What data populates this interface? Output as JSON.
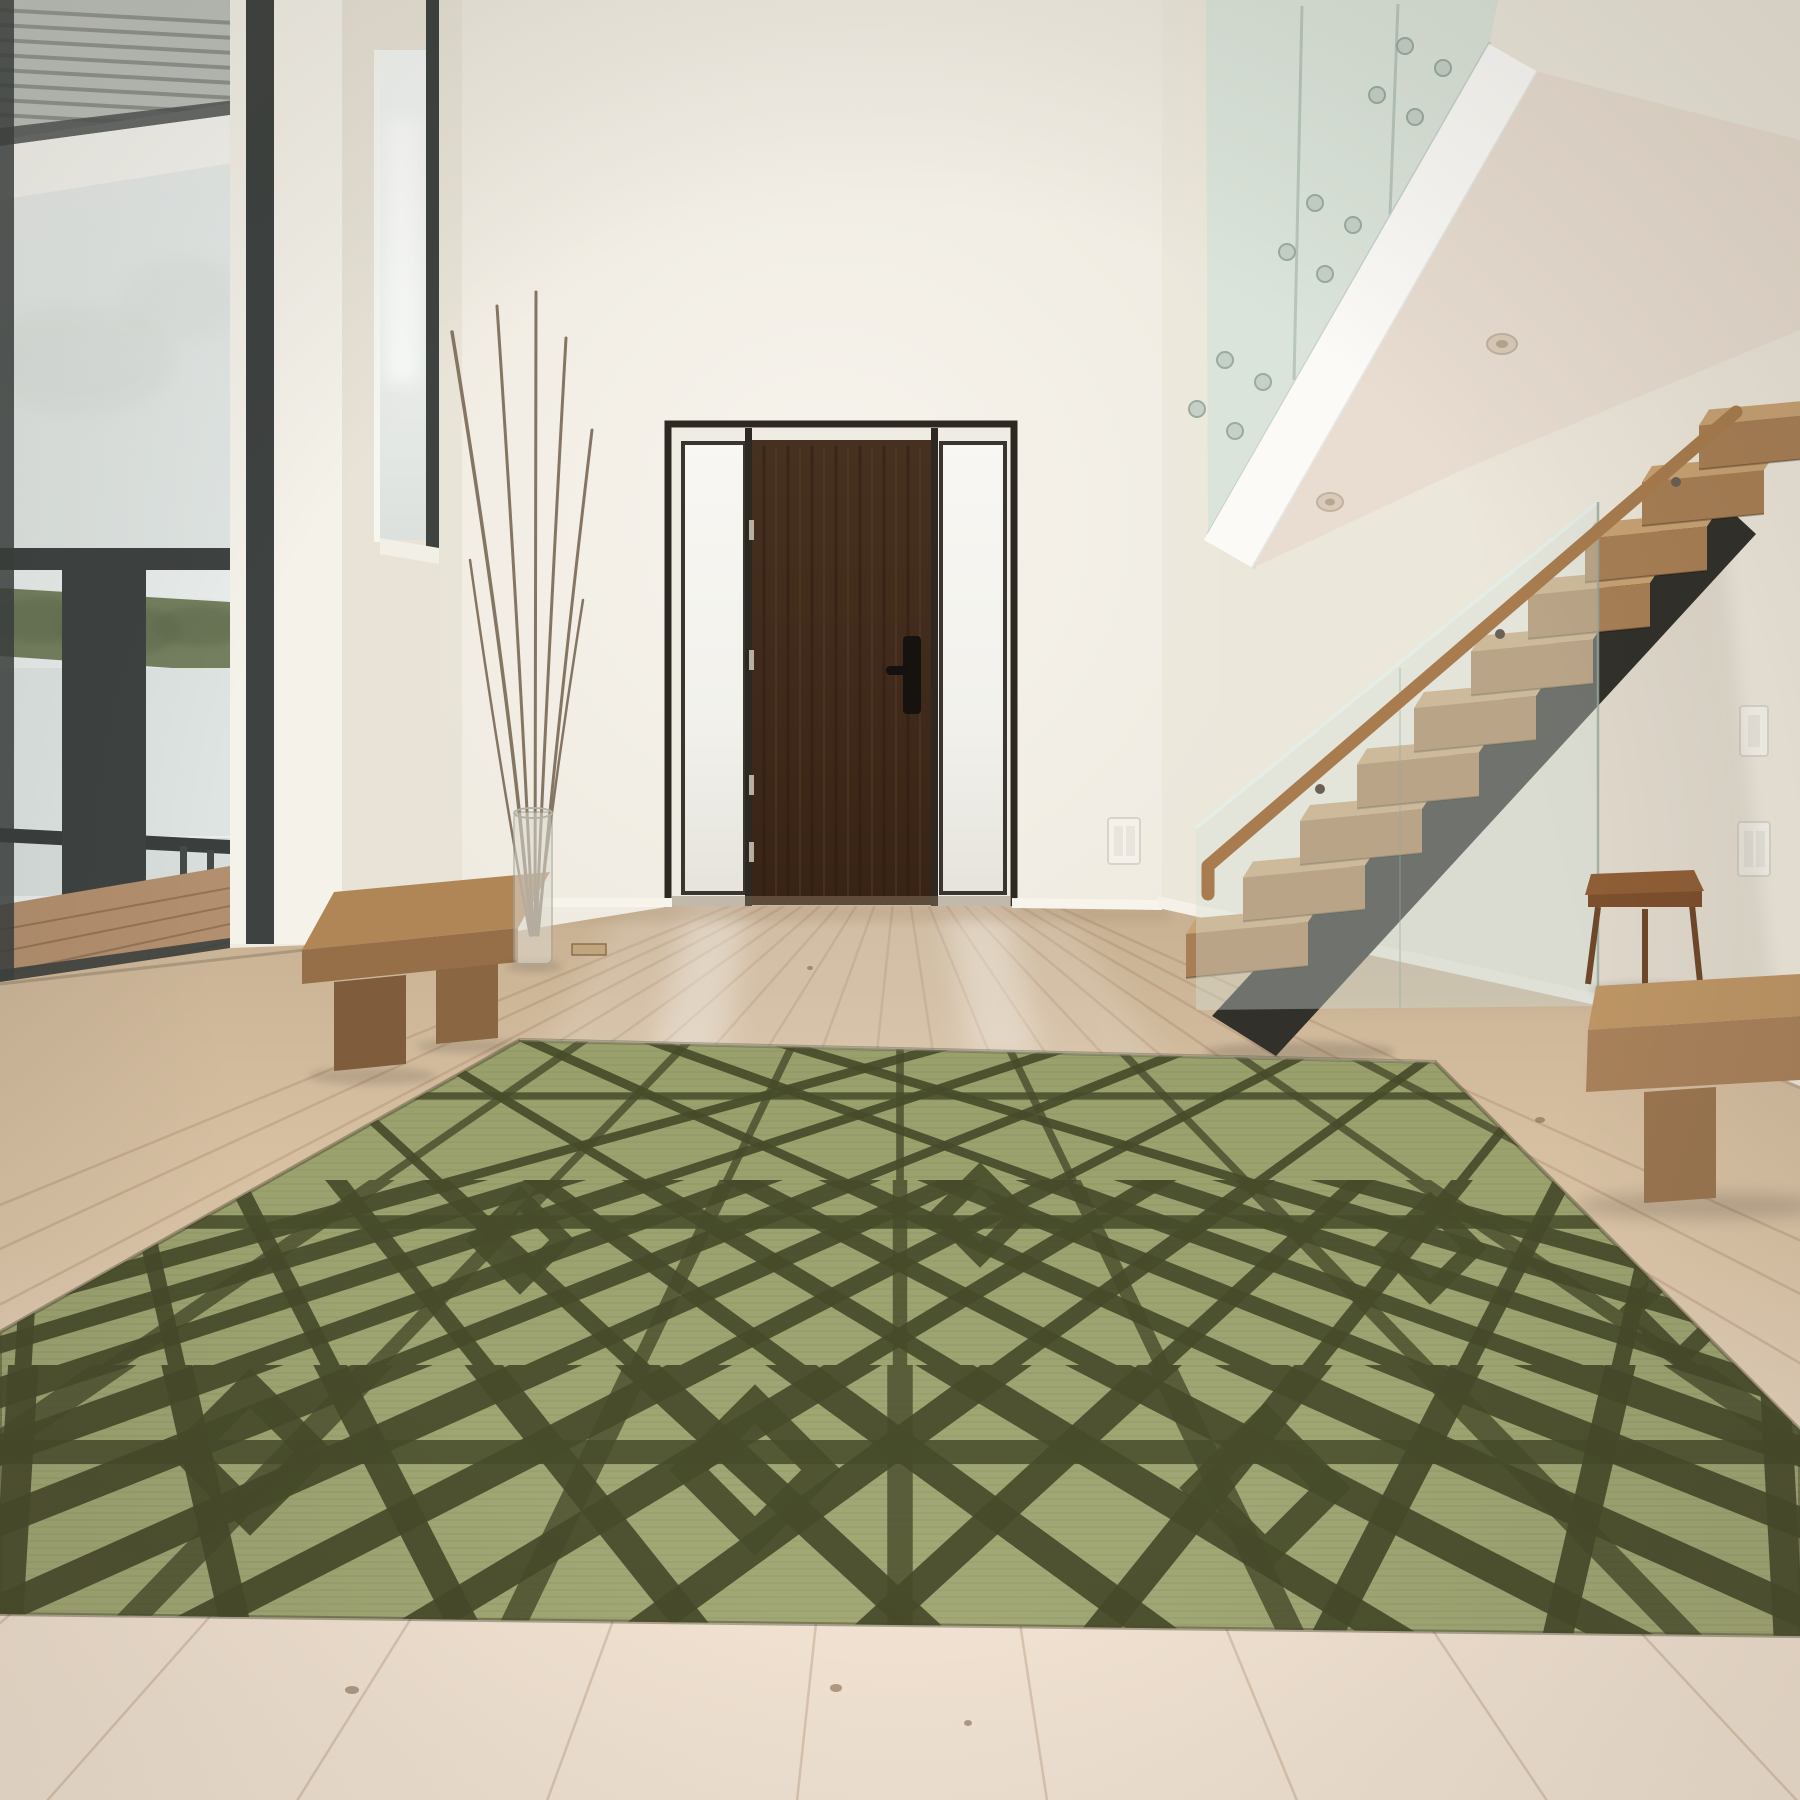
{
  "meta": {
    "type": "interior-photograph",
    "room": "double-height modern entry hall",
    "style": "minimalist, white walls, light oak floor"
  },
  "colors": {
    "wall": "#efebe1",
    "wall_dim": "#e2dccd",
    "wall_bright": "#f8f5ef",
    "wall_edge": "#eae4d7",
    "ceiling_white": "#fbfaf6",
    "soffit": "#e8ddd0",
    "frame_dark": "#3e4240",
    "sky": "#e9edeb",
    "trees": "#74805f",
    "trees_dark": "#5f6b4d",
    "water": "#dde4e2",
    "deck": "#b28f6e",
    "railing": "#3a3f3e",
    "door_wood": "#422c1d",
    "door_wood_light": "#6f4e2f",
    "door_frame": "#2e2822",
    "sidelight": "#f5f4ef",
    "handle": "#16130f",
    "hinge": "#cfc7b8",
    "tread_top": "#c8a273",
    "tread_front": "#a87f55",
    "stringer": "#32302a",
    "handrail": "#a87c4e",
    "table_wood": "#8e5e36",
    "bench_right_top": "#bd9565",
    "bench_right_front": "#a8815a",
    "bench_right_leg": "#9a7650",
    "bench_left_top": "#b08656",
    "bench_left_front": "#966f48",
    "bench_left_leg": "#7e5c3c",
    "vase_glass": "#dcd9cf",
    "branch": "#857663",
    "floor_far": "#c8b193",
    "floor_mid": "#dcc5a7",
    "floor_near": "#f2e2d1",
    "seam": "#9b7856",
    "rug_base_top": "#99a06c",
    "rug_base_bottom": "#a3a976",
    "rug_line": "#474b2a",
    "glass_tint": "#d6e3da",
    "glass_edge": "#a9bcae",
    "switch_plate": "#f4f1ea"
  },
  "objects": {
    "front_door": {
      "material": "dark walnut",
      "state": "closed",
      "hinges": 4,
      "handle": "black vertical pull",
      "sidelights": 2,
      "sidelight_glazing": "frosted"
    },
    "staircase": {
      "visible_treads": 10,
      "tread_material": "white oak",
      "stringer": "dark steel mono-stringer",
      "balustrade": "frameless glass",
      "handrail": "oak on standoffs"
    },
    "mezzanine": {
      "balustrade": "frameless glass with standoff fittings",
      "fascia": "white",
      "recessed_downlights": 2
    },
    "windows": {
      "left": "full-height glazing with outdoor view",
      "clerestory": "slatted soffit visible, top left",
      "narrow_vertical": "left of entry wall"
    },
    "outdoor_view": [
      "sky",
      "tree line",
      "water",
      "deck boards",
      "dark railing posts"
    ],
    "furniture": [
      "wood slab bench (left wall)",
      "wood slab bench (right foreground)",
      "small wood console under stairs",
      "tall glass vase with dry branches"
    ],
    "rug": {
      "placement": "centre foreground, seen in perspective",
      "base_color": "sage green",
      "pattern": "dark olive geometric trellis of interlocking diamonds, lattices and rectangles",
      "texture": "ribbed weave"
    },
    "floor": {
      "material": "wide-plank light oak",
      "details": [
        "plank seams converging to horizon",
        "small knots",
        "brass floor vent",
        "light reflections below door sidelights"
      ]
    },
    "fixtures": {
      "switch_plates": 2
    }
  }
}
